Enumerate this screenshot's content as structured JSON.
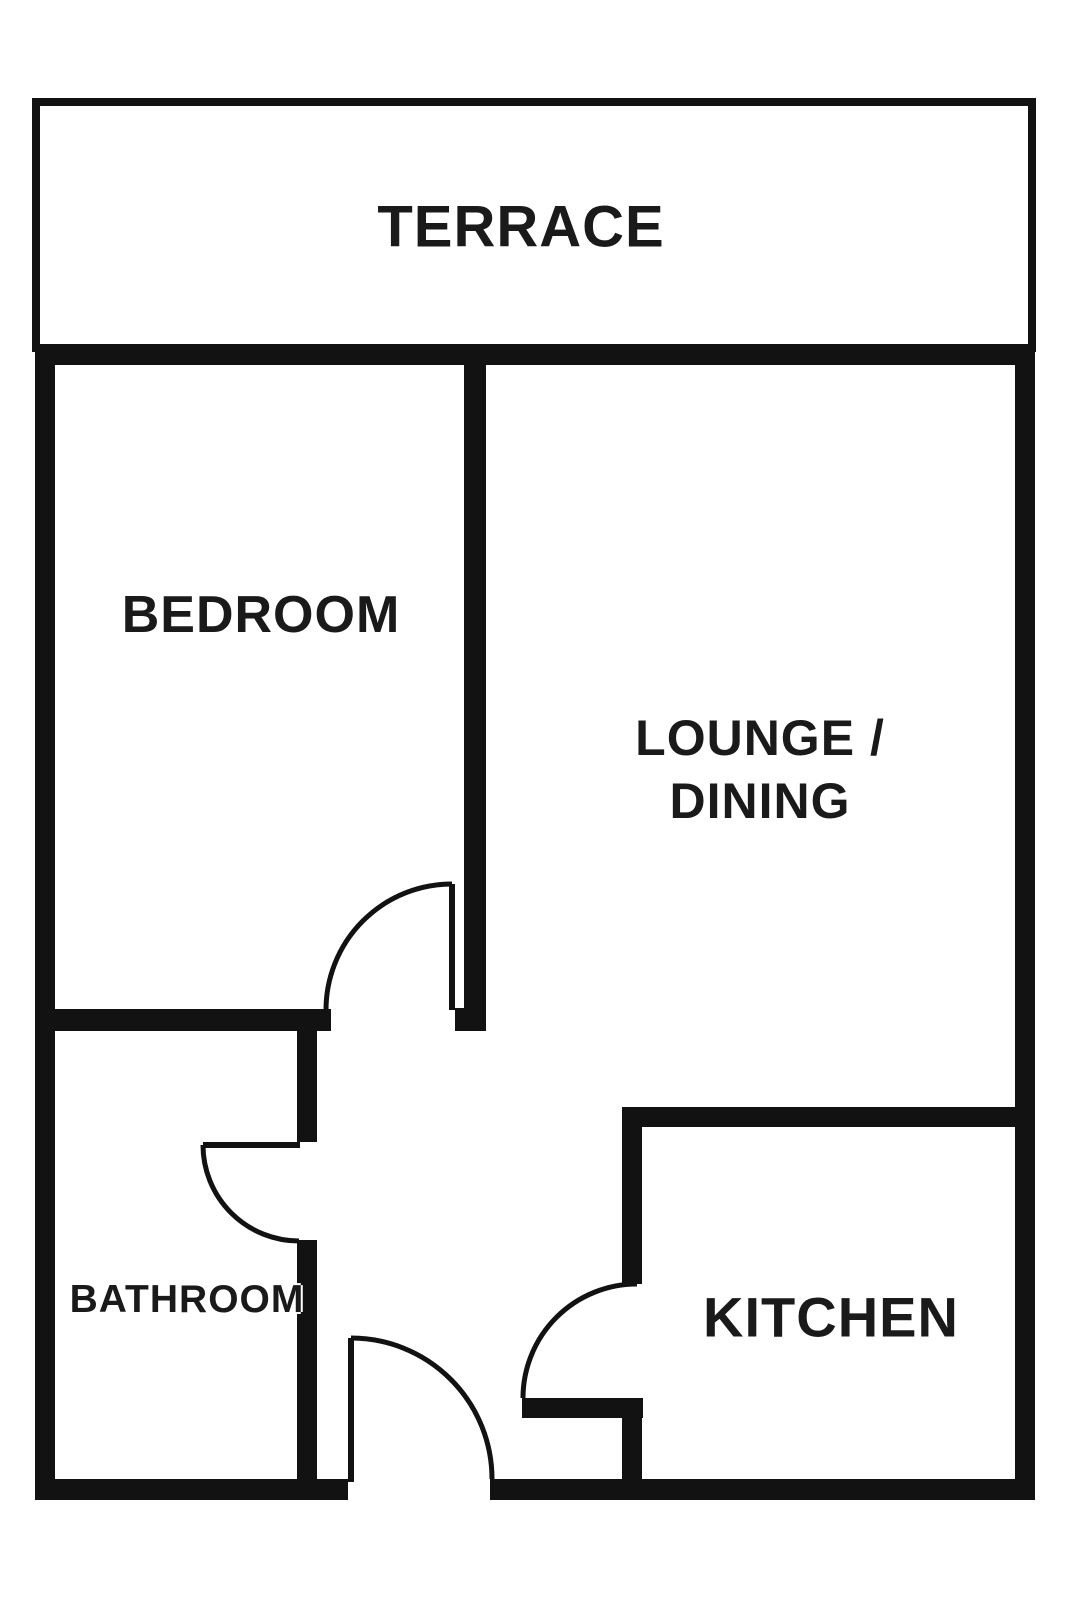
{
  "colors": {
    "wall": "#121212",
    "text": "#1a1a1a",
    "background": "#ffffff"
  },
  "rooms": {
    "terrace": {
      "label": "TERRACE"
    },
    "bedroom": {
      "label": "BEDROOM"
    },
    "lounge": {
      "label_line1": "LOUNGE /",
      "label_line2": "DINING"
    },
    "bathroom": {
      "label": "BATHROOM"
    },
    "kitchen": {
      "label": "KITCHEN"
    }
  }
}
